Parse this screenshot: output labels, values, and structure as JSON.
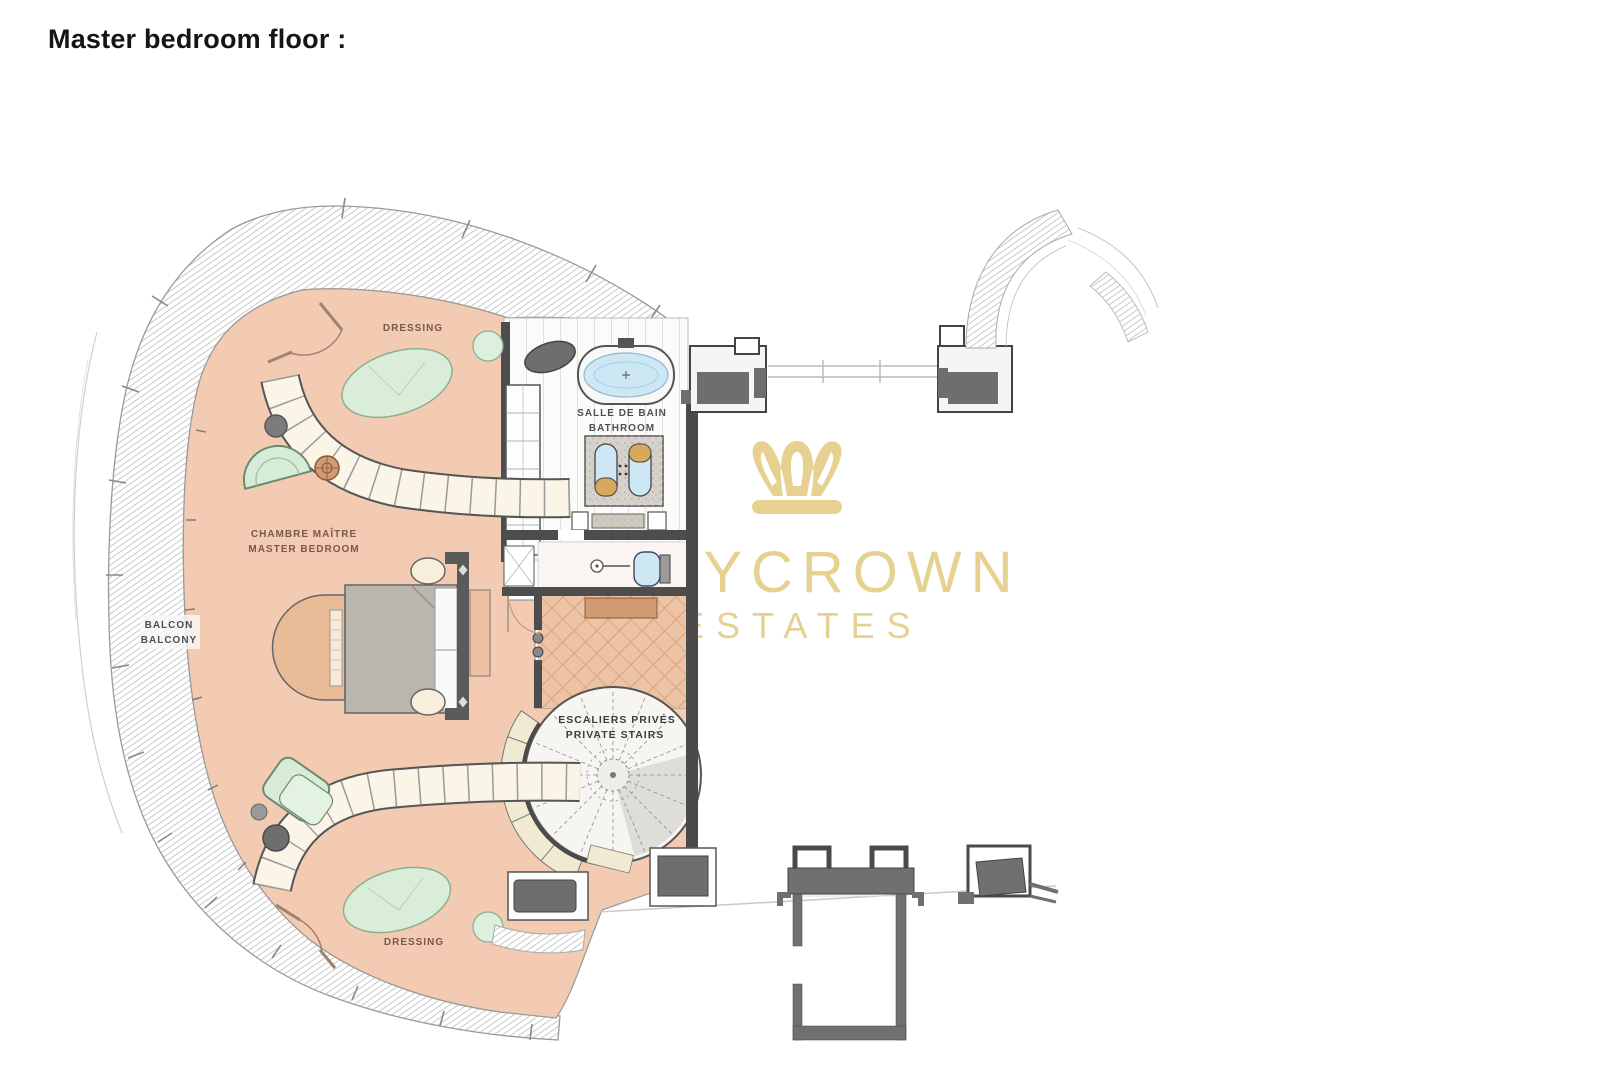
{
  "page": {
    "title": "Master bedroom floor :"
  },
  "watermark": {
    "brand": "MYCROWN",
    "subtitle": "ESTATES",
    "color": "#e7d190"
  },
  "plan": {
    "labels": {
      "dressing_top": "DRESSING",
      "salle_de_bain": "SALLE DE BAIN",
      "bathroom": "BATHROOM",
      "chambre_maitre": "CHAMBRE MAÎTRE",
      "master_bedroom": "MASTER BEDROOM",
      "balcon": "BALCON",
      "balcony": "BALCONY",
      "escaliers_prives": "ESCALIERS PRIVÉS",
      "private_stairs": "PRIVATE STAIRS",
      "dressing_bottom": "DRESSING"
    },
    "colors": {
      "floor_peach": "#f2cbb2",
      "corridor_parquet": "#ecc3a4",
      "rug_green": "#d9edd9",
      "wall_gray": "#4d4d4d",
      "tub_blue": "#cde8f4",
      "closet_cream": "#f7f1df",
      "watermark_gold": "#e7d190"
    }
  }
}
